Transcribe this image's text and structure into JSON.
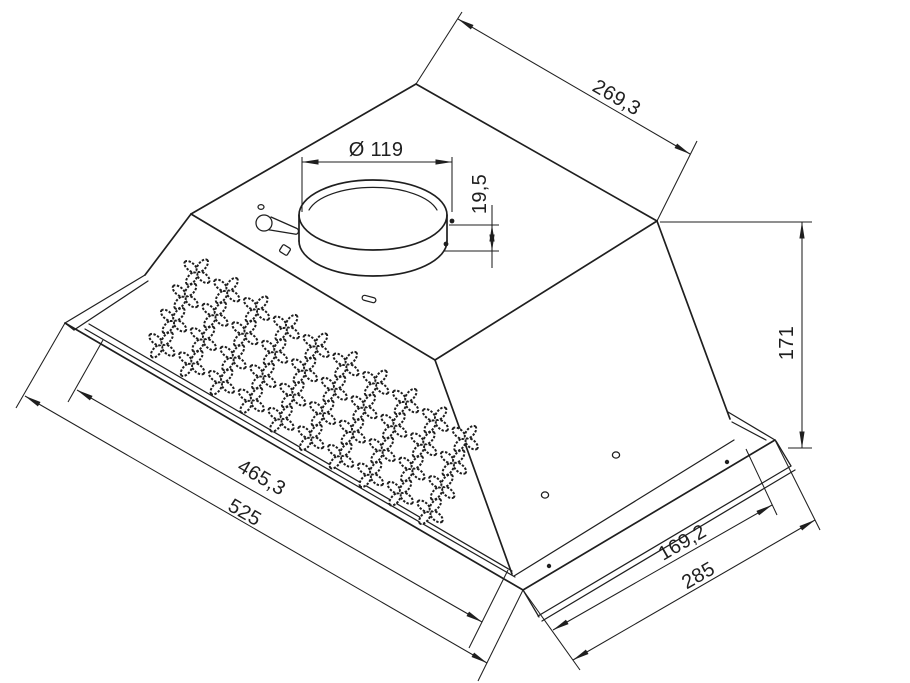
{
  "drawing": {
    "background": "#ffffff",
    "line_color": "#1f1f1f",
    "type": "isometric technical drawing of built-in cooker hood",
    "dimensions": {
      "top_depth": "269,3",
      "spigot_diameter": "Ø 119",
      "spigot_height": "19,5",
      "body_height": "171",
      "cutout_width": "465,3",
      "overall_width": "525",
      "cutout_depth": "169,2",
      "overall_depth": "285"
    },
    "perforations": {
      "rows": 4,
      "columns": 10
    }
  }
}
